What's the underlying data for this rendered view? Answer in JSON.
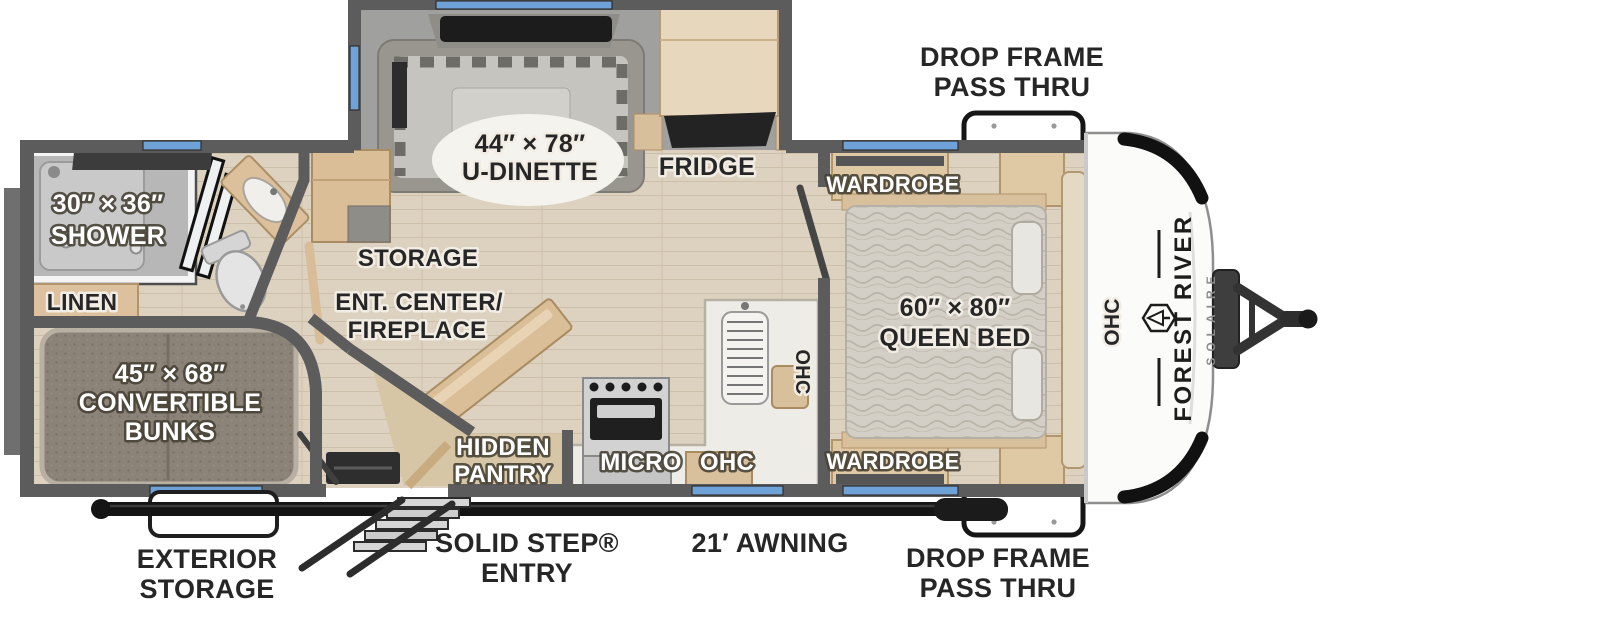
{
  "floorplan": {
    "branding": {
      "make": "FOREST RIVER",
      "model": "SOLAIRE"
    },
    "labels": {
      "drop_frame_top": {
        "line1": "DROP FRAME",
        "line2": "PASS THRU"
      },
      "drop_frame_bottom": {
        "line1": "DROP FRAME",
        "line2": "PASS THRU"
      },
      "u_dinette": {
        "line1": "44″ × 78″",
        "line2": "U-DINETTE"
      },
      "fridge": "FRIDGE",
      "shower": {
        "line1": "30″ × 36″",
        "line2": "SHOWER"
      },
      "linen": "LINEN",
      "storage": "STORAGE",
      "ent_center": {
        "line1": "ENT. CENTER/",
        "line2": "FIREPLACE"
      },
      "bunks": {
        "line1": "45″ × 68″",
        "line2": "CONVERTIBLE",
        "line3": "BUNKS"
      },
      "hidden_pantry": {
        "line1": "HIDDEN",
        "line2": "PANTRY"
      },
      "micro": "MICRO",
      "ohc_bottom": "OHC",
      "ohc_kitchen": "OHC",
      "ohc_front": "OHC",
      "wardrobe_top": "WARDROBE",
      "wardrobe_bottom": "WARDROBE",
      "queen_bed": {
        "line1": "60″ × 80″",
        "line2": "QUEEN BED"
      },
      "exterior_storage": {
        "line1": "EXTERIOR",
        "line2": "STORAGE"
      },
      "solid_step": {
        "line1": "SOLID STEP®",
        "line2": "ENTRY"
      },
      "awning": "21′ AWNING"
    },
    "colors": {
      "wall_gray": "#5c5c5c",
      "floor_wood": "#ddd2c0",
      "slide_floor": "#a0a09e",
      "cabinet_tan": "#dcc29d",
      "window_blue": "#6fa3d8",
      "awning_black": "#161616",
      "counter_white": "#edece7",
      "label_dark": "#262626",
      "label_white": "#ffffff"
    }
  }
}
